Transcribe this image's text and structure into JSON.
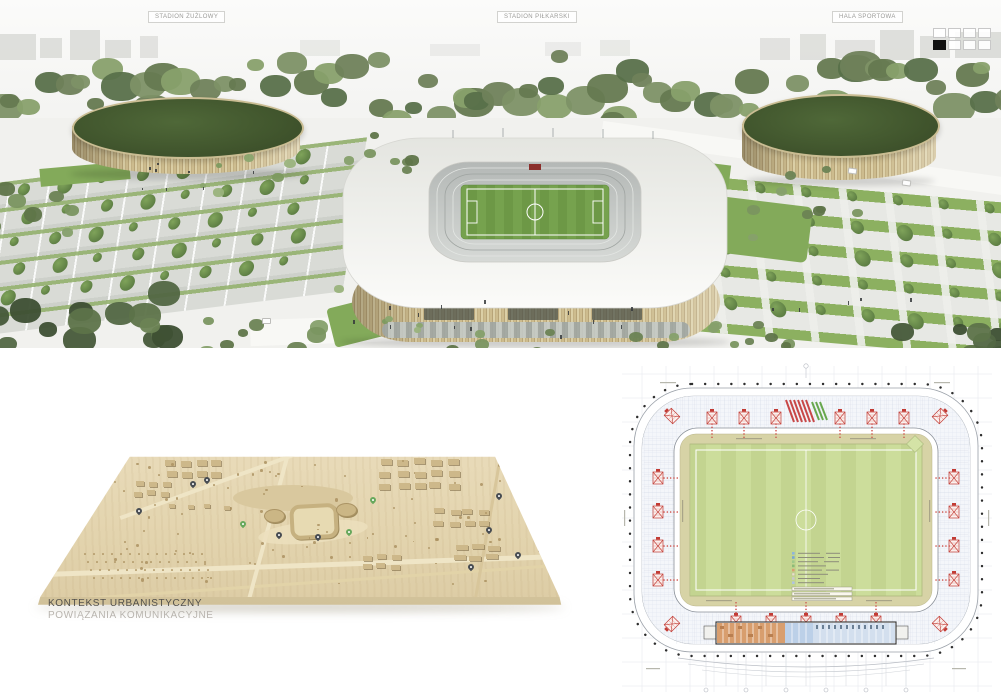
{
  "board": {
    "top_labels": {
      "left": "STADION ŻUŻLOWY",
      "center": "STADION PIŁKARSKI",
      "right": "HALA SPORTOWA"
    },
    "page_indicator": {
      "rows": 2,
      "cols": 4,
      "active_index": 4
    }
  },
  "model_section": {
    "title": "KONTEKST URBANISTYCZNY",
    "subtitle": "POWIĄZANIA KOMUNIKACYJNE"
  },
  "colors": {
    "facade_timber": "#c9b888",
    "roof_white": "#f5f5f2",
    "pitch_green": "#74a24d",
    "hall_roof_green": "#465c33",
    "tree_green": "#6b8354",
    "model_wood": "#e0d1a9",
    "plan_pitch": "#c8d993",
    "plan_red": "#c23b34",
    "plan_rooms_orange": "#d89e6e",
    "plan_rooms_blue": "#cfdded",
    "label_text": "#9b9b98",
    "caption_title": "#53514c",
    "caption_subtitle": "#b8b4ae",
    "indicator_active": "#111111"
  }
}
